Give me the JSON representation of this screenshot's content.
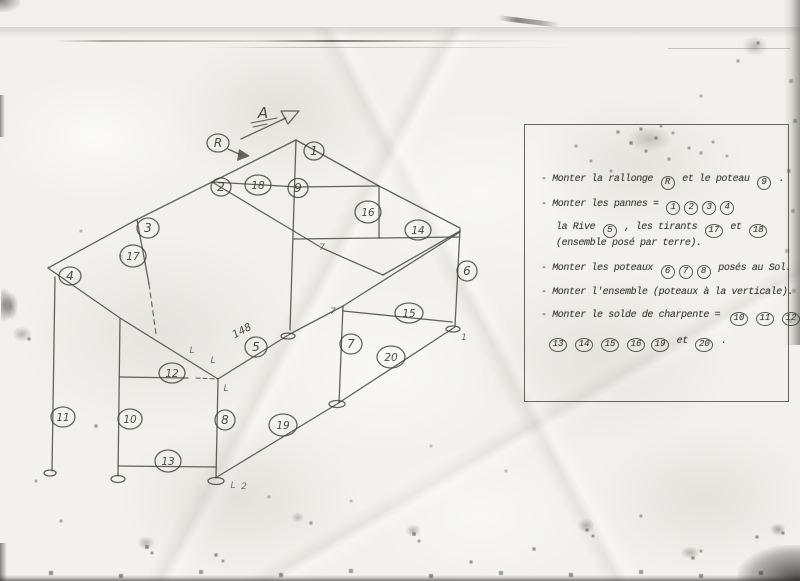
{
  "colors": {
    "pencil": "#45423c",
    "paper": "#f2f1ed",
    "scan_background": "#f1f0ec"
  },
  "legend": {
    "lines": [
      {
        "parts": [
          {
            "type": "text",
            "v": "- Monter la rallonge "
          },
          {
            "type": "circle",
            "v": "R"
          },
          {
            "type": "text",
            "v": " et le poteau "
          },
          {
            "type": "circle",
            "v": "9"
          },
          {
            "type": "text",
            "v": " ."
          }
        ]
      },
      {
        "parts": [
          {
            "type": "text",
            "v": "- Monter les pannes = "
          },
          {
            "type": "circle",
            "v": "1"
          },
          {
            "type": "circle",
            "v": "2"
          },
          {
            "type": "circle",
            "v": "3"
          },
          {
            "type": "circle",
            "v": "4"
          }
        ]
      },
      {
        "parts": [
          {
            "type": "text",
            "v": "la Rive "
          },
          {
            "type": "circle",
            "v": "5"
          },
          {
            "type": "text",
            "v": " , les tirants "
          },
          {
            "type": "circle",
            "v": "17"
          },
          {
            "type": "text",
            "v": " et "
          },
          {
            "type": "circle",
            "v": "18"
          }
        ]
      },
      {
        "parts": [
          {
            "type": "text",
            "v": "(ensemble posé par terre)."
          }
        ]
      },
      {
        "parts": [
          {
            "type": "text",
            "v": "- Monter les poteaux "
          },
          {
            "type": "circle",
            "v": "6"
          },
          {
            "type": "circle",
            "v": "7"
          },
          {
            "type": "circle",
            "v": "8"
          },
          {
            "type": "text",
            "v": " posés au Sol."
          }
        ]
      },
      {
        "parts": [
          {
            "type": "text",
            "v": "- Monter l'ensemble (poteaux à la verticale)."
          }
        ]
      },
      {
        "parts": [
          {
            "type": "text",
            "v": "- Monter le solde de charpente = "
          },
          {
            "type": "circle",
            "v": "10"
          },
          {
            "type": "circle",
            "v": "11"
          },
          {
            "type": "circle",
            "v": "12"
          }
        ]
      },
      {
        "parts": [
          {
            "type": "circle",
            "v": "13"
          },
          {
            "type": "circle",
            "v": "14"
          },
          {
            "type": "circle",
            "v": "15"
          },
          {
            "type": "circle",
            "v": "16"
          },
          {
            "type": "circle",
            "v": "19"
          },
          {
            "type": "text",
            "v": " et "
          },
          {
            "type": "circle",
            "v": "20"
          },
          {
            "type": "text",
            "v": " ."
          }
        ]
      }
    ]
  },
  "diagram": {
    "direction_label": "A",
    "measure_label": "148",
    "nodes": [
      {
        "label": "R"
      },
      {
        "label": "1"
      },
      {
        "label": "2"
      },
      {
        "label": "18"
      },
      {
        "label": "9"
      },
      {
        "label": "16"
      },
      {
        "label": "14"
      },
      {
        "label": "6"
      },
      {
        "label": "3"
      },
      {
        "label": "17"
      },
      {
        "label": "4"
      },
      {
        "label": "11"
      },
      {
        "label": "10"
      },
      {
        "label": "12"
      },
      {
        "label": "8"
      },
      {
        "label": "13"
      },
      {
        "label": "5"
      },
      {
        "label": "7"
      },
      {
        "label": "15"
      },
      {
        "label": "19"
      },
      {
        "label": "20"
      }
    ],
    "tick_marks": [
      {
        "g": "7"
      },
      {
        "g": "7"
      },
      {
        "g": "L"
      },
      {
        "g": "L"
      },
      {
        "g": "L"
      },
      {
        "g": "L"
      },
      {
        "g": "2"
      },
      {
        "g": "1"
      }
    ]
  }
}
